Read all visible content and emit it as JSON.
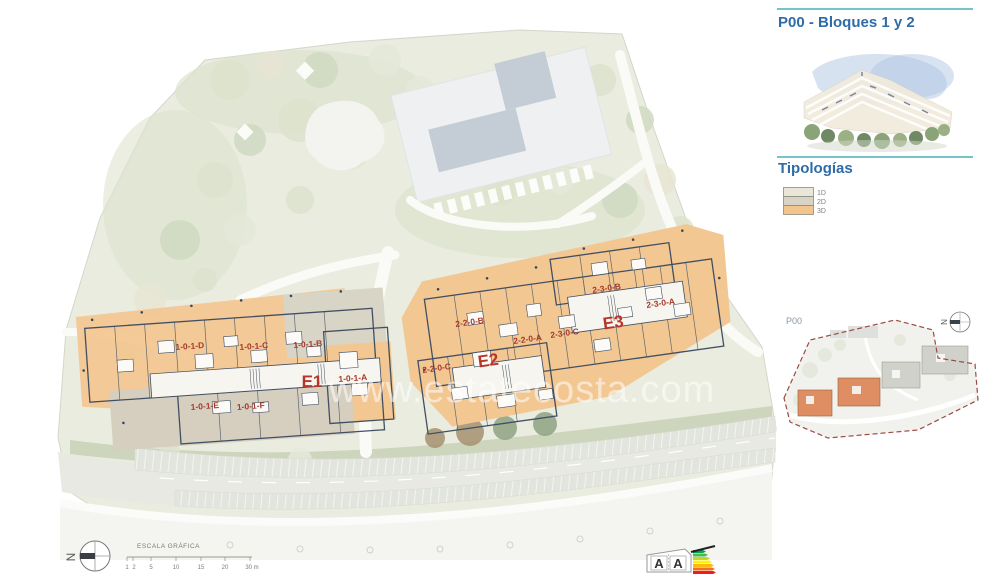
{
  "panel": {
    "title": "P00 - Bloques 1 y 2",
    "typologies_heading": "Tipologías",
    "legend": {
      "items": [
        {
          "label": "1D",
          "color": "#e9e6d8"
        },
        {
          "label": "2D",
          "color": "#d8d3c5"
        },
        {
          "label": "3D",
          "color": "#f2c58e"
        }
      ]
    },
    "minimap": {
      "label": "P00",
      "north_letter": "N"
    }
  },
  "plan": {
    "watermark": "www.estatecosta.com",
    "north_letter": "N",
    "block1": {
      "core_label": "E1",
      "units": [
        {
          "label": "1-0-1-D"
        },
        {
          "label": "1-0-1-C"
        },
        {
          "label": "1-0-1-B"
        },
        {
          "label": "1-0-1-A"
        },
        {
          "label": "1-0-1-E"
        },
        {
          "label": "1-0-1-F"
        }
      ]
    },
    "block2": {
      "core_labels": [
        {
          "label": "E2"
        },
        {
          "label": "E3"
        }
      ],
      "units": [
        {
          "label": "2-2-0-B"
        },
        {
          "label": "2-2-0-A"
        },
        {
          "label": "2-3-0-C"
        },
        {
          "label": "2-3-0-B"
        },
        {
          "label": "2-3-0-A"
        },
        {
          "label": "2-2-0-C"
        }
      ]
    },
    "scalebar": {
      "title": "ESCALA GRÁFICA",
      "ticks": [
        "1",
        "2",
        "5",
        "10",
        "15",
        "20",
        "30 m"
      ]
    }
  },
  "energy_label": {
    "letters": [
      "A",
      "A"
    ]
  },
  "colors": {
    "accent_teal": "#74c4ca",
    "heading_blue": "#2e6ca8",
    "unit_label_red": "#a43a2b",
    "core_label_red": "#b8352a",
    "typology_1d": "#e9e6d8",
    "typology_2d": "#d8d3c5",
    "typology_3d": "#f2c58e",
    "minimap_boundary_red": "#9c4a42"
  }
}
